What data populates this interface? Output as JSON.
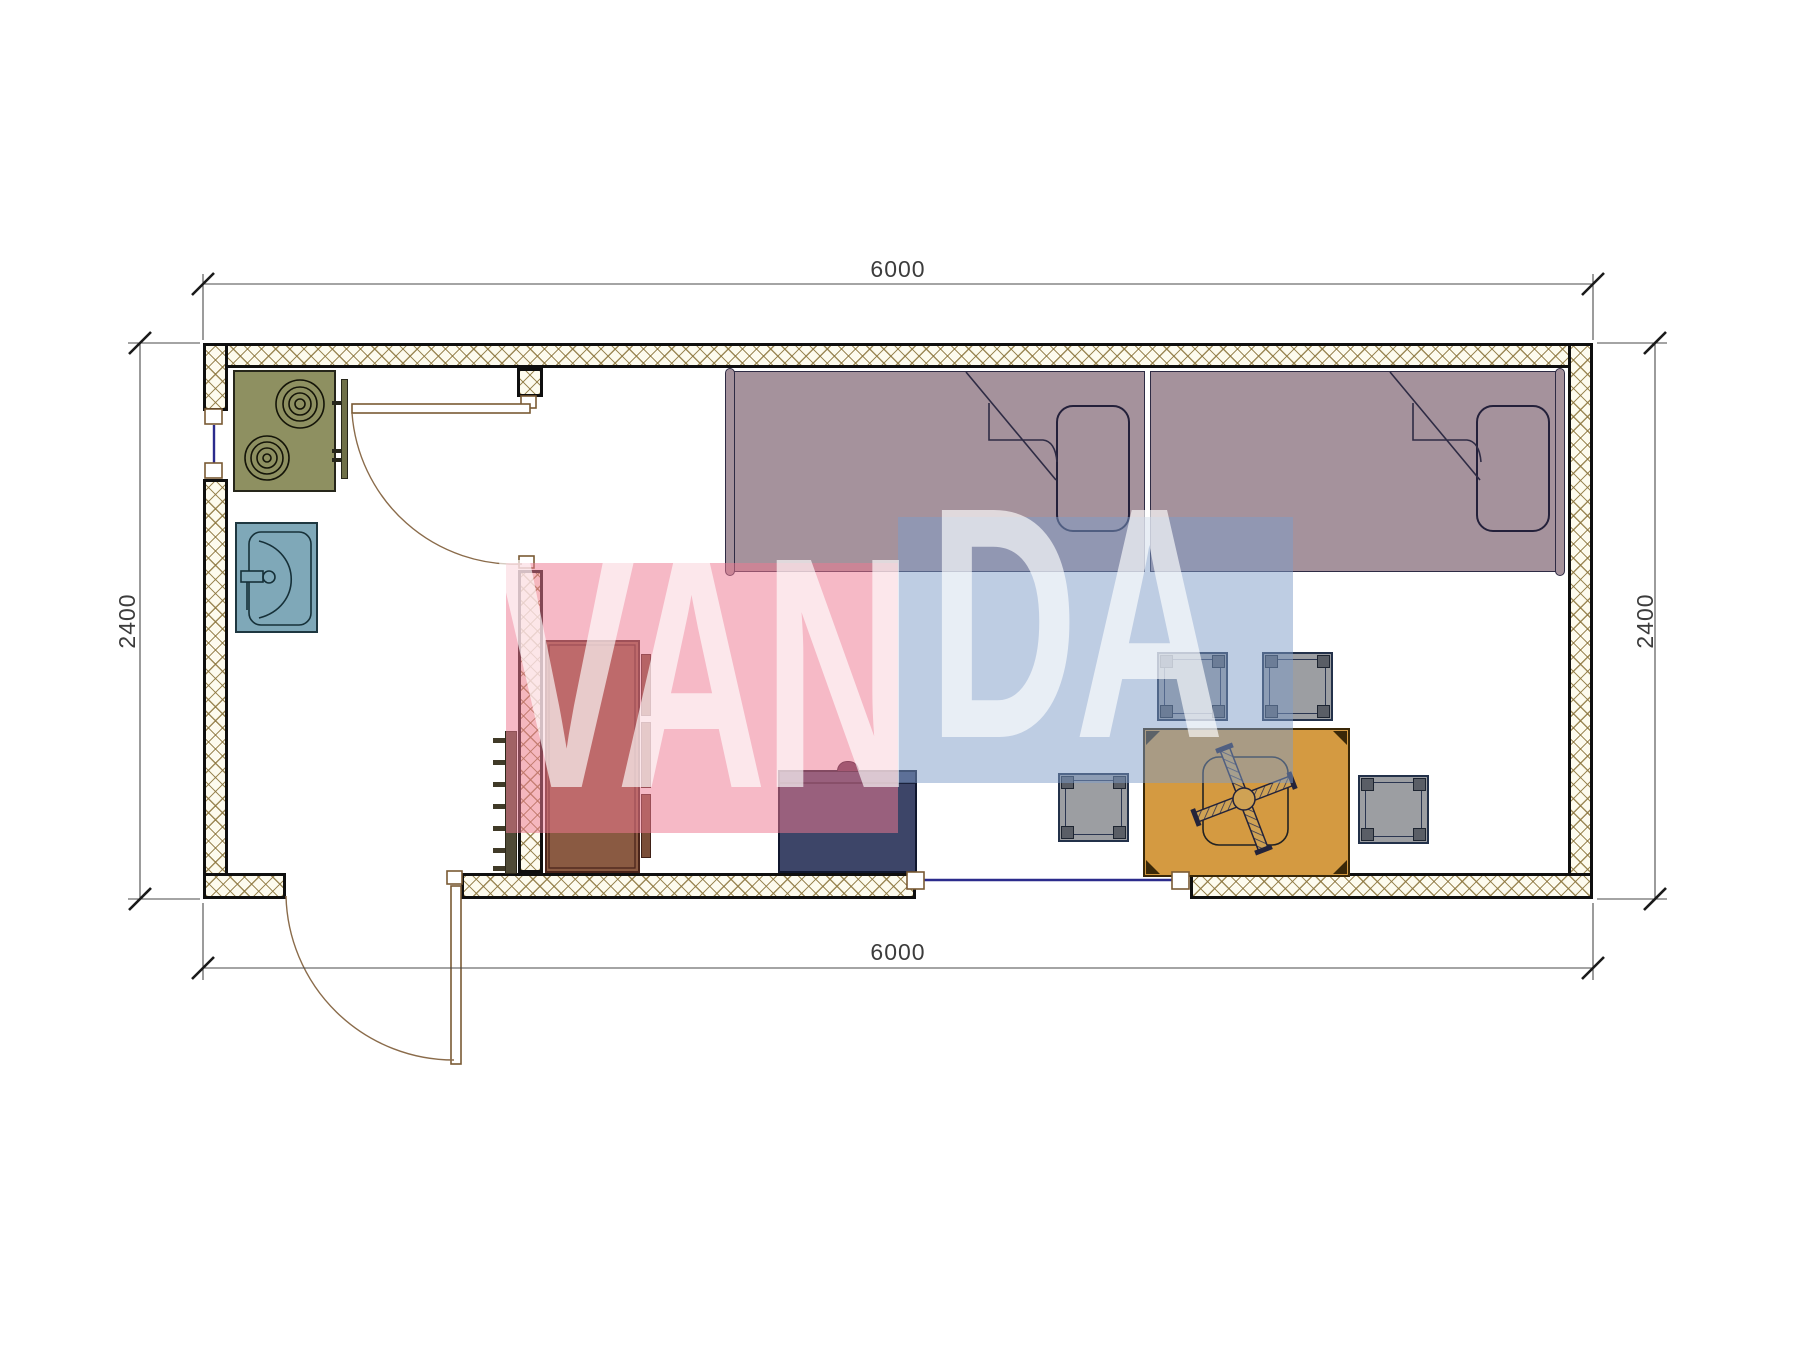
{
  "drawing": {
    "type": "architectural floor plan",
    "subject": "container cabin room layout with kitchen corner, two single beds, wardrobe and dining table"
  },
  "dimensions": {
    "top": "6000",
    "bottom": "6000",
    "left": "2400",
    "right": "2400"
  },
  "watermark": {
    "text": "VANDA",
    "segment_pink": "VAN",
    "segment_blue": "DA",
    "pink_color": "rgba(238,120,146,0.52)",
    "blue_color": "rgba(125,155,200,0.50)",
    "letter_color": "rgba(255,255,255,0.65)"
  },
  "furniture": {
    "stove": "two-burner cooktop",
    "sink": "washbasin with faucet",
    "wardrobe": "wardrobe with side shelves",
    "ladder": "towel ladder radiator",
    "cabinet": "low cabinet with knob",
    "bed_left": "single bed with pillow and folded blanket",
    "bed_right": "single bed with pillow and folded blanket",
    "table": "dining table with folding cross base",
    "stool": "square stool",
    "interior_door": "swing door to kitchen corner",
    "exterior_door": "entry swing door",
    "window_left": "window in left wall",
    "window_bottom": "window in bottom wall"
  },
  "colors": {
    "wall_hatch_line": "#8c7644",
    "wall_edge": "#0f0f0f",
    "bed": "#a5929c",
    "stove": "#8e9061",
    "sink": "#7fa8b8",
    "wardrobe": "#8a5a42",
    "cabinet": "#3d4568",
    "table": "#d49a41",
    "stool": "#9c9ea2",
    "window_line": "#2b2b8c",
    "door_line": "#8a6b4a",
    "dimension_line": "#444444"
  }
}
